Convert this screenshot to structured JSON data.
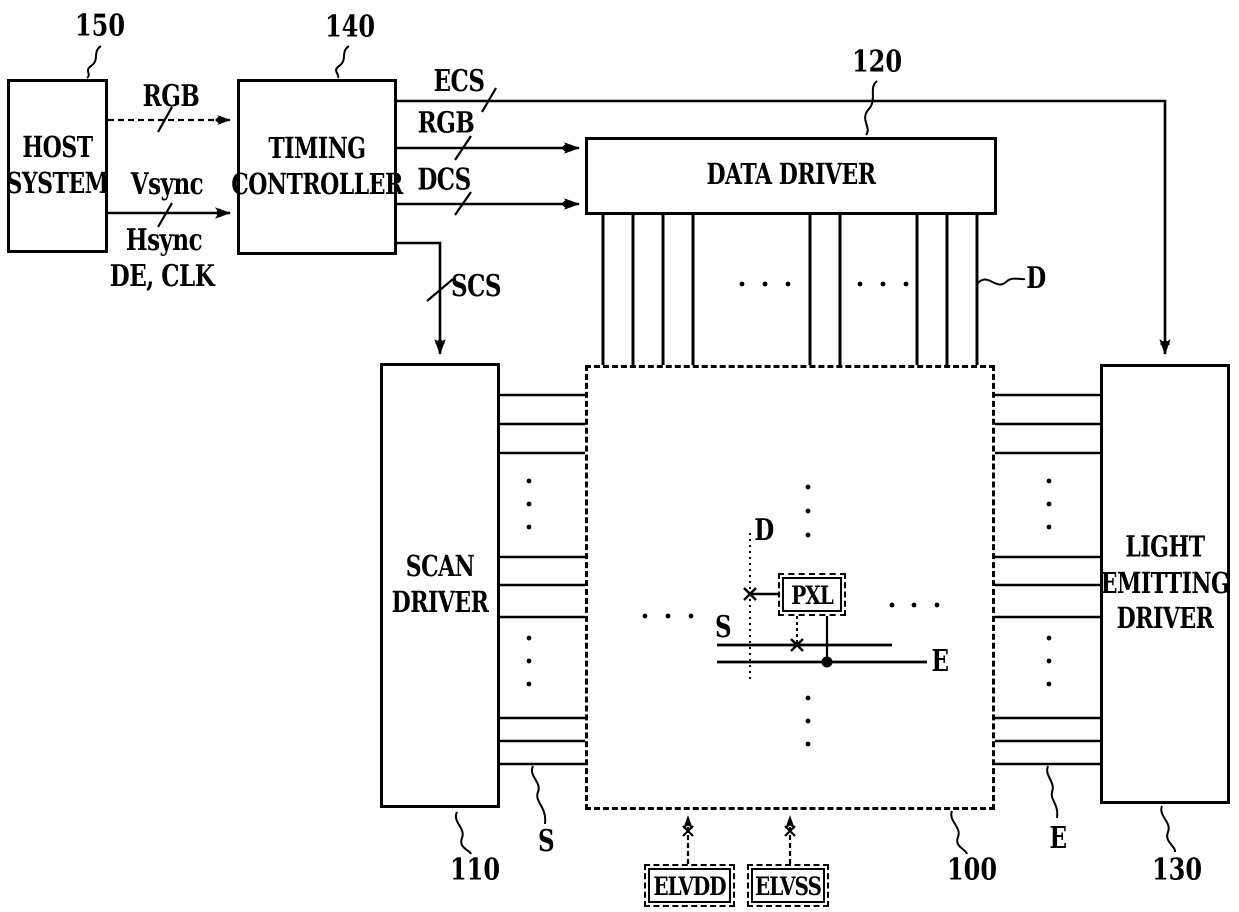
{
  "blocks": {
    "host_system": {
      "label": "HOST\nSYSTEM",
      "ref": "150"
    },
    "timing_controller": {
      "label": "TIMING\nCONTROLLER",
      "ref": "140"
    },
    "data_driver": {
      "label": "DATA DRIVER",
      "ref": "120"
    },
    "scan_driver": {
      "label": "SCAN\nDRIVER",
      "ref": "110"
    },
    "display_panel": {
      "ref": "100"
    },
    "light_emitting_driver": {
      "label": "LIGHT\nEMITTING\nDRIVER",
      "ref": "130"
    },
    "pixel": {
      "label": "PXL"
    }
  },
  "signals": {
    "host_rgb": "RGB",
    "vsync": "Vsync",
    "hsync": "Hsync",
    "de_clk": "DE, CLK",
    "ecs": "ECS",
    "rgb": "RGB",
    "dcs": "DCS",
    "scs": "SCS"
  },
  "line_labels": {
    "data_bus": "D",
    "scan_bus": "S",
    "emit_bus": "E",
    "pixel_data": "D",
    "pixel_scan": "S",
    "pixel_emit": "E"
  },
  "power": {
    "elvdd": "ELVDD",
    "elvss": "ELVSS"
  },
  "colors": {
    "ink": "#000000",
    "background": "#ffffff"
  }
}
